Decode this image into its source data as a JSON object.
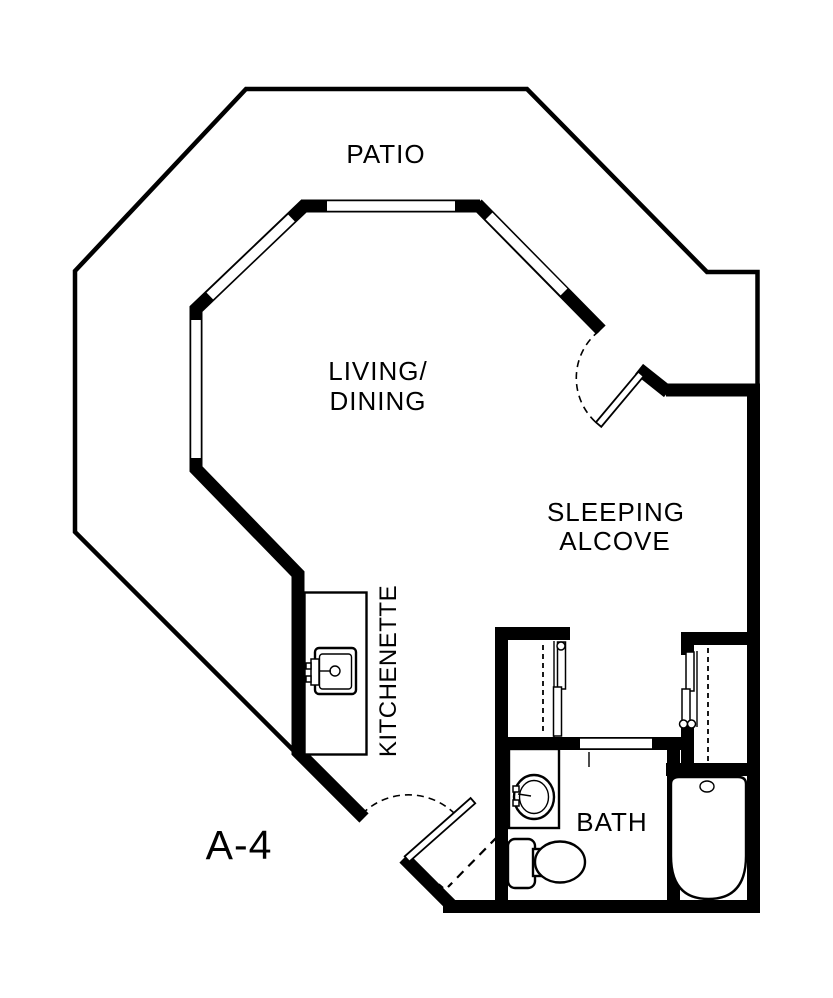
{
  "floor_plan": {
    "unit_label": "A-4",
    "rooms": {
      "patio": {
        "label": "PATIO"
      },
      "living_dining": {
        "line1": "LIVING/",
        "line2": "DINING"
      },
      "sleeping_alcove": {
        "line1": "SLEEPING",
        "line2": "ALCOVE"
      },
      "kitchenette": {
        "label": "KITCHENETTE"
      },
      "bath": {
        "label": "BATH"
      }
    },
    "colors": {
      "wall": "#000000",
      "background": "#ffffff"
    },
    "fixtures": [
      "kitchen-sink",
      "bath-sink",
      "toilet",
      "bathtub",
      "closet-left",
      "closet-right"
    ]
  }
}
